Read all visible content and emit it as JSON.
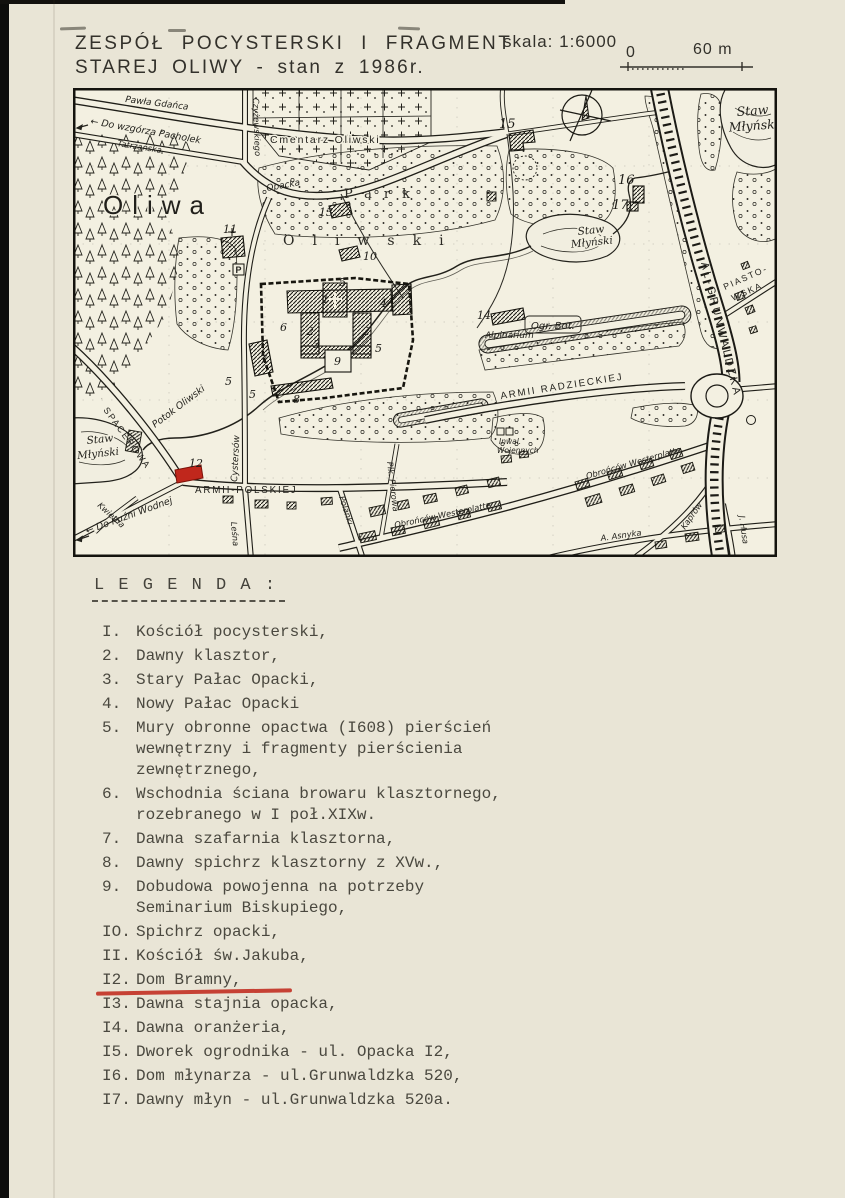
{
  "colors": {
    "paper": "#e9e5d6",
    "map_bg": "#f3f0e1",
    "ink": "#24231e",
    "accent_red": "#c0271c"
  },
  "title": {
    "line1": "ZESPÓŁ POCYSTERSKI I FRAGMENT",
    "line2": "STAREJ OLIWY - stan z 1986r.",
    "scale": "skala: 1:6000",
    "bar_zero": "0",
    "bar_end": "60 m"
  },
  "map": {
    "labels": {
      "oliwa": "Oliwa",
      "park_spread": "Park",
      "oliwski_spread": "Oliwski",
      "cmentarz": "Cmentarz Oliwski",
      "ogr_bot": "Ogr. Bot.",
      "alpinarium": "Alpinarium",
      "inwal_1": "Inwal.",
      "inwal_2": "Wojennych",
      "parking": "P",
      "potok": "Potok Oliwski"
    },
    "water": {
      "staw": "Staw",
      "mlynski": "Młyński"
    },
    "streets": {
      "pawla_gdanca": "Pawła Gdańca",
      "do_wzgorza": "← Do wzgórza Pacholek",
      "tatrzanska": "Tatrzańska",
      "czyzewskiego": "Czyżewskiego",
      "opacka": "Opacka",
      "cystersow": "Cystersów",
      "spacerowa": "SPACEROWA",
      "armii_polskiej": "ARMII-POLSKIEJ",
      "armii_radzieckiej": "ARMII RADZIECKIEJ",
      "obroncow_westerplatte": "Obrońców Westerplatte",
      "al_grunwaldzka": "AL-GRUNWALDZKA",
      "piastowska_1": "PIASTO-",
      "piastowska_2": "WSKA",
      "polanki": "Polanki",
      "lesna": "Leśna",
      "kwietna": "Kwietna",
      "plk_pierowa": "Płk. Pierowa",
      "do_kuzni": "← Do Kuźni Wodnej",
      "kaprow": "Kaprów",
      "j_husa": "J. Husa",
      "a_asnyka": "A. Asnyka"
    },
    "markers": [
      {
        "n": "1",
        "x": 249,
        "y": 215
      },
      {
        "n": "2",
        "x": 234,
        "y": 247
      },
      {
        "n": "2",
        "x": 290,
        "y": 247
      },
      {
        "n": "3",
        "x": 240,
        "y": 260
      },
      {
        "n": "4",
        "x": 307,
        "y": 219
      },
      {
        "n": "5",
        "x": 266,
        "y": 198
      },
      {
        "n": "5",
        "x": 302,
        "y": 264
      },
      {
        "n": "5",
        "x": 176,
        "y": 310
      },
      {
        "n": "5",
        "x": 152,
        "y": 297
      },
      {
        "n": "6",
        "x": 207,
        "y": 243
      },
      {
        "n": "7",
        "x": 187,
        "y": 275
      },
      {
        "n": "8",
        "x": 220,
        "y": 315
      },
      {
        "n": "9",
        "x": 261,
        "y": 277
      },
      {
        "n": "10",
        "x": 290,
        "y": 172
      },
      {
        "n": "11",
        "x": 150,
        "y": 145
      },
      {
        "n": "12",
        "x": 116,
        "y": 379
      },
      {
        "n": "13",
        "x": 246,
        "y": 128
      },
      {
        "n": "14",
        "x": 404,
        "y": 231
      },
      {
        "n": "15",
        "x": 426,
        "y": 40,
        "big": true
      },
      {
        "n": "16",
        "x": 545,
        "y": 96,
        "big": true
      },
      {
        "n": "17",
        "x": 539,
        "y": 121,
        "big": true
      }
    ]
  },
  "legend": {
    "header": "L E G E N D A :",
    "items": [
      {
        "num": "I.",
        "lines": [
          "Kościół pocysterski,"
        ]
      },
      {
        "num": "2.",
        "lines": [
          "Dawny klasztor,"
        ]
      },
      {
        "num": "3.",
        "lines": [
          "Stary Pałac Opacki,"
        ]
      },
      {
        "num": "4.",
        "lines": [
          "Nowy Pałac Opacki"
        ]
      },
      {
        "num": "5.",
        "lines": [
          "Mury obronne opactwa (I608) pierścień",
          "wewnętrzny i fragmenty pierścienia",
          "zewnętrznego,"
        ]
      },
      {
        "num": "6.",
        "lines": [
          "Wschodnia ściana browaru klasztornego,",
          "rozebranego w I poł.XIXw."
        ]
      },
      {
        "num": "7.",
        "lines": [
          "Dawna szafarnia klasztorna,"
        ]
      },
      {
        "num": "8.",
        "lines": [
          "Dawny spichrz klasztorny z XVw.,"
        ]
      },
      {
        "num": "9.",
        "lines": [
          "Dobudowa powojenna na potrzeby",
          "Seminarium Biskupiego,"
        ]
      },
      {
        "num": "IO.",
        "lines": [
          "Spichrz opacki,"
        ]
      },
      {
        "num": "II.",
        "lines": [
          "Kościół św.Jakuba,"
        ]
      },
      {
        "num": "I2.",
        "lines": [
          "Dom Bramny,"
        ],
        "highlight": true
      },
      {
        "num": "I3.",
        "lines": [
          "Dawna stajnia opacka,"
        ]
      },
      {
        "num": "I4.",
        "lines": [
          "Dawna oranżeria,"
        ]
      },
      {
        "num": "I5.",
        "lines": [
          "Dworek ogrodnika - ul. Opacka I2,"
        ]
      },
      {
        "num": "I6.",
        "lines": [
          "Dom młynarza - ul.Grunwaldzka 520,"
        ]
      },
      {
        "num": "I7.",
        "lines": [
          "Dawny młyn - ul.Grunwaldzka 520a."
        ]
      }
    ]
  }
}
